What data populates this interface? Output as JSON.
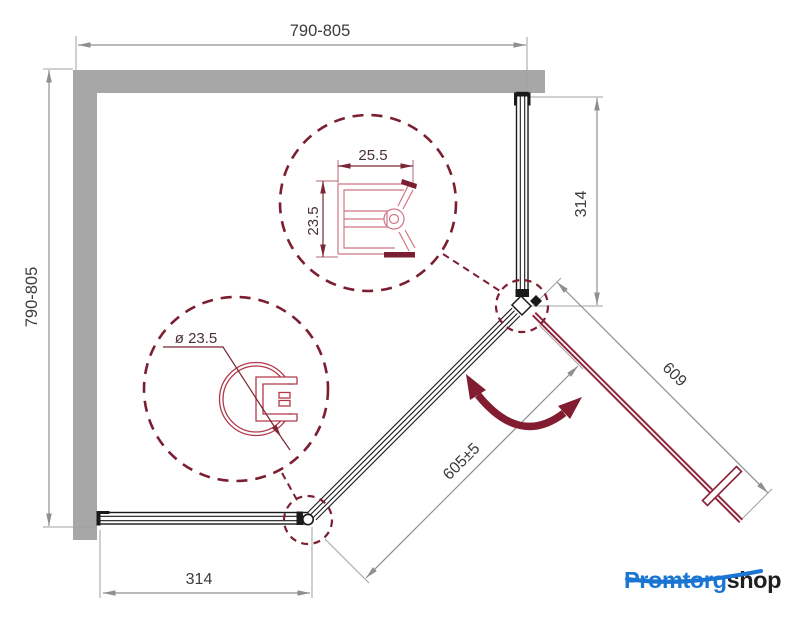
{
  "drawing": {
    "dimensions": {
      "top_width": "790-805",
      "left_depth": "790-805",
      "right_fixed_panel": "314",
      "bottom_fixed_panel": "314",
      "door_width": "609",
      "opening_width": "605±5"
    },
    "profile_details": {
      "wall_profile": {
        "width": "25.5",
        "height": "23.5"
      },
      "round_profile": {
        "diameter": "ø 23.5"
      }
    }
  },
  "logo": {
    "part1": "Promtorg",
    "part2": "shop"
  },
  "colors": {
    "wall": "#a7a7a7",
    "dimension_line": "#8f8f8f",
    "accent_maroon": "#7c1e31",
    "door_maroon": "#8e2138",
    "logo_blue": "#1b75d2",
    "logo_dark": "#1f1f1f"
  },
  "icons": {
    "door_swing": "double-curved-arrow",
    "logo_underline": "blue-swoosh"
  }
}
